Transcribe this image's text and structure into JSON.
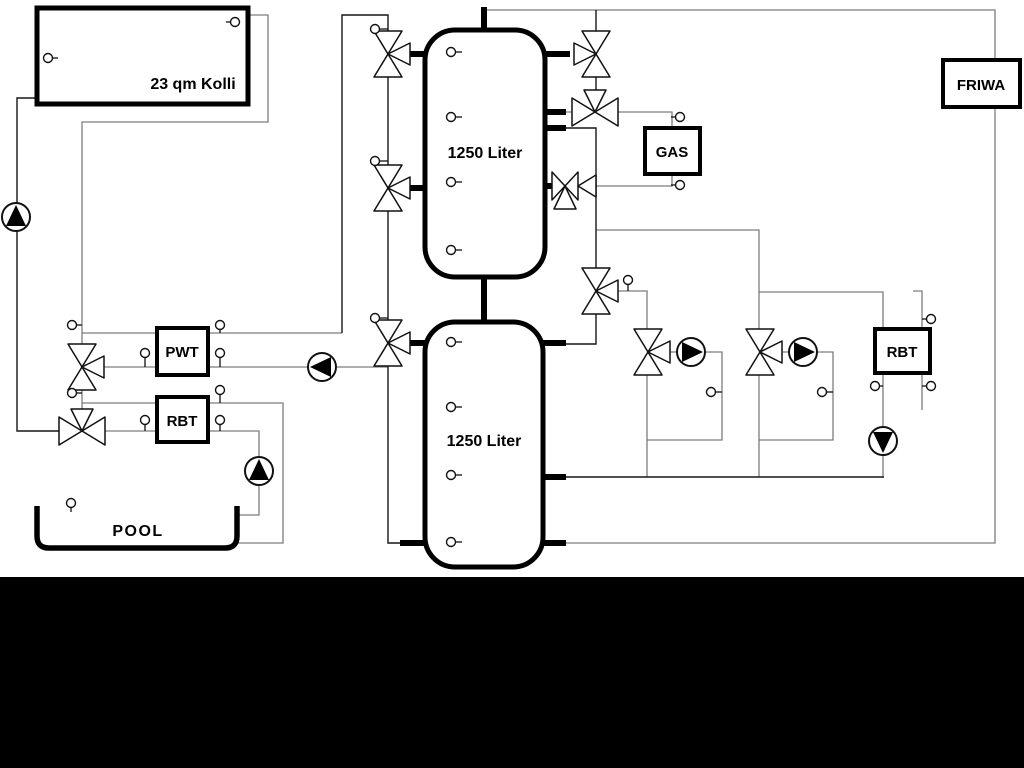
{
  "diagram": {
    "labels": {
      "collector": "23 qm Kolli",
      "tank_top": "1250 Liter",
      "tank_bottom": "1250 Liter",
      "gas": "GAS",
      "friwa": "FRIWA",
      "pwt": "PWT",
      "rbt_left": "RBT",
      "rbt_right": "RBT",
      "pool": "POOL"
    },
    "colors": {
      "background": "#ffffff",
      "pipe_gray": "#7d7d7d",
      "pipe_black": "#161616",
      "component_stroke": "#000000",
      "bottom_bar": "#000000"
    },
    "components": {
      "valves": [
        {
          "x": 388,
          "y": 54,
          "t": "vr"
        },
        {
          "x": 388,
          "y": 188,
          "t": "vr"
        },
        {
          "x": 388,
          "y": 343,
          "t": "vr"
        },
        {
          "x": 82,
          "y": 367,
          "t": "vr"
        },
        {
          "x": 596,
          "y": 291,
          "t": "vr"
        },
        {
          "x": 648,
          "y": 352,
          "t": "vr"
        },
        {
          "x": 760,
          "y": 352,
          "t": "vr"
        },
        {
          "x": 596,
          "y": 54,
          "t": "vl"
        },
        {
          "x": 595,
          "y": 112,
          "t": "ht"
        },
        {
          "x": 82,
          "y": 431,
          "t": "ht"
        },
        {
          "x": 565,
          "y": 186,
          "t": "hbr"
        }
      ],
      "pumps": [
        {
          "x": 16,
          "y": 217,
          "d": "up"
        },
        {
          "x": 259,
          "y": 471,
          "d": "up"
        },
        {
          "x": 322,
          "y": 367,
          "d": "left"
        },
        {
          "x": 691,
          "y": 352,
          "d": "right"
        },
        {
          "x": 803,
          "y": 352,
          "d": "right"
        },
        {
          "x": 883,
          "y": 441,
          "d": "down"
        }
      ],
      "sensors": [
        [
          235,
          22,
          226,
          22
        ],
        [
          48,
          58,
          58,
          58
        ],
        [
          375,
          29,
          388,
          29
        ],
        [
          375,
          161,
          388,
          161
        ],
        [
          375,
          318,
          388,
          318
        ],
        [
          451,
          52,
          462,
          52
        ],
        [
          451,
          117,
          462,
          117
        ],
        [
          451,
          182,
          462,
          182
        ],
        [
          451,
          250,
          462,
          250
        ],
        [
          451,
          342,
          462,
          342
        ],
        [
          451,
          407,
          462,
          407
        ],
        [
          451,
          475,
          462,
          475
        ],
        [
          451,
          542,
          462,
          542
        ],
        [
          72,
          325,
          82,
          325
        ],
        [
          145,
          353,
          145,
          367
        ],
        [
          220,
          325,
          220,
          333
        ],
        [
          220,
          353,
          220,
          367
        ],
        [
          72,
          393,
          82,
          393
        ],
        [
          220,
          390,
          220,
          403
        ],
        [
          145,
          420,
          145,
          431
        ],
        [
          220,
          420,
          220,
          431
        ],
        [
          71,
          503,
          71,
          512
        ],
        [
          680,
          117,
          671,
          117
        ],
        [
          680,
          185,
          671,
          185
        ],
        [
          628,
          280,
          628,
          291
        ],
        [
          711,
          392,
          722,
          392
        ],
        [
          822,
          392,
          833,
          392
        ],
        [
          875,
          386,
          883,
          386
        ],
        [
          931,
          319,
          922,
          319
        ],
        [
          931,
          386,
          922,
          386
        ]
      ]
    }
  }
}
